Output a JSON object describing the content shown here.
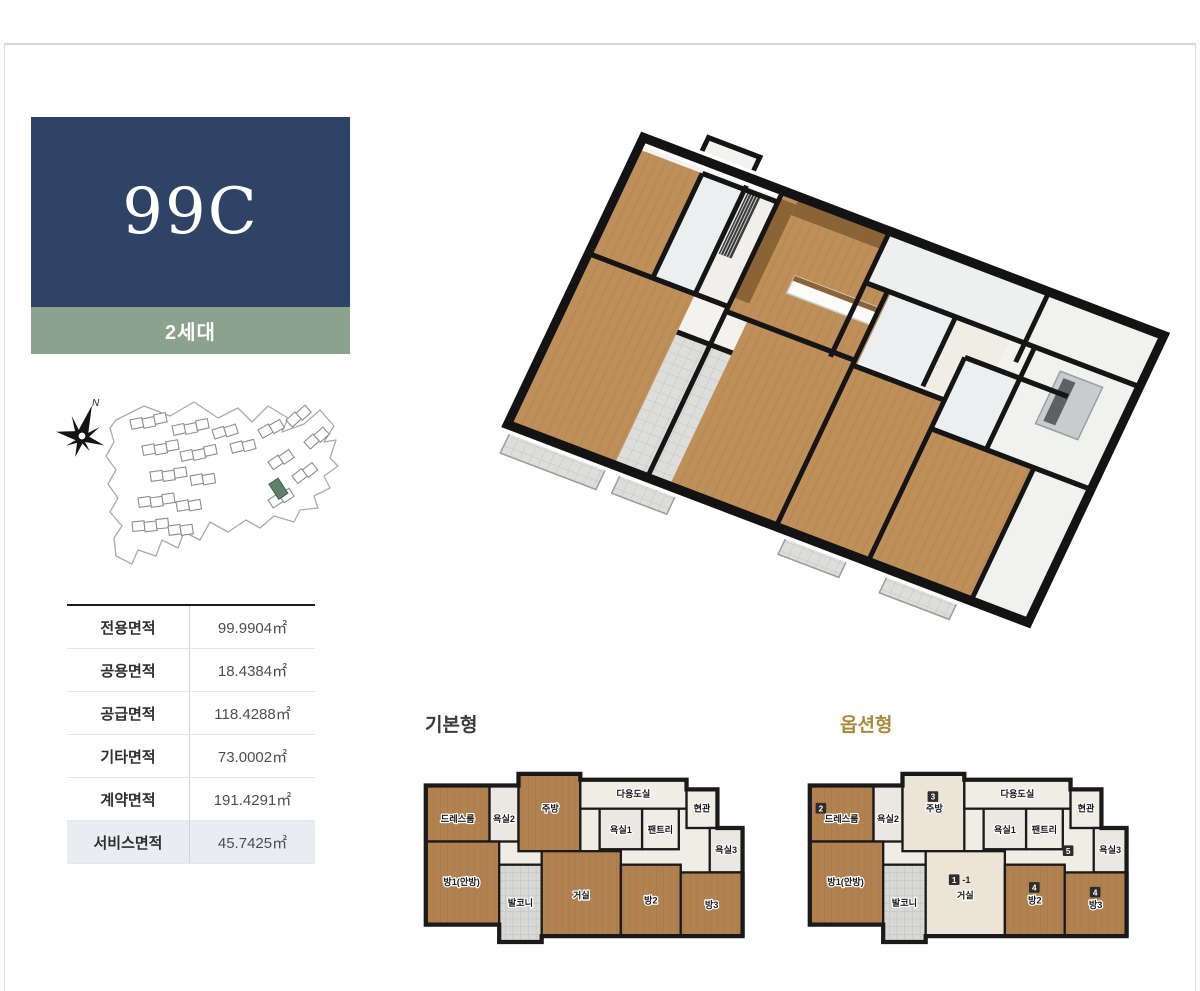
{
  "page": {
    "frame_border_color": "#d6d6d6"
  },
  "sidebar": {
    "unit_code": "99C",
    "households": "2세대",
    "colors": {
      "unit_bg": "#2e4365",
      "households_bg": "#8ba28e",
      "sitemap_highlight": "#5e8169"
    },
    "sitemap": {
      "compass_label": "N"
    },
    "area_table": {
      "rows": [
        {
          "label": "전용면적",
          "value": "99.9904㎡"
        },
        {
          "label": "공용면적",
          "value": "18.4384㎡"
        },
        {
          "label": "공급면적",
          "value": "118.4288㎡"
        },
        {
          "label": "기타면적",
          "value": "73.0002㎡"
        },
        {
          "label": "계약면적",
          "value": "191.4291㎡"
        },
        {
          "label": "서비스면적",
          "value": "45.7425㎡"
        }
      ]
    }
  },
  "plans": {
    "basic": {
      "label": "기본형",
      "label_color": "#3b3b3b"
    },
    "option": {
      "label": "옵션형",
      "label_color": "#ab8a3d",
      "badges": [
        {
          "text": "2",
          "x": 12,
          "y": 48
        },
        {
          "text": "3",
          "x": 128,
          "y": 36
        },
        {
          "text": "1-1",
          "x": 150,
          "y": 122
        },
        {
          "text": "4",
          "x": 233,
          "y": 130
        },
        {
          "text": "4",
          "x": 296,
          "y": 135
        },
        {
          "text": "5",
          "x": 268,
          "y": 92
        }
      ]
    },
    "floors": {
      "wood": "#b28150",
      "woodline": "#a3744a",
      "tile": "#eae8e1",
      "light": "#f0ede5",
      "balcony": "#d8d8d6",
      "cream": "#ece4d6",
      "wall": "#1a1a1a"
    },
    "outline": "M6,30 H102 V18 H166 V24 H276 V34 H308 V74 H334 V186 H126 V192 H82 V174 H6 Z",
    "rooms": [
      {
        "label": "드레스룸",
        "x": 6,
        "y": 30,
        "w": 66,
        "h": 58,
        "floor": "wood",
        "lx": 39,
        "ly": 68
      },
      {
        "label": "욕실2",
        "x": 72,
        "y": 30,
        "w": 30,
        "h": 58,
        "floor": "tile",
        "lx": 87,
        "ly": 68
      },
      {
        "label": "주방",
        "x": 102,
        "y": 18,
        "w": 64,
        "h": 80,
        "floor": "wood",
        "lx": 135,
        "ly": 57,
        "optfloor": "cream"
      },
      {
        "label": "다용도실",
        "x": 166,
        "y": 24,
        "w": 110,
        "h": 30,
        "floor": "light",
        "lx": 221,
        "ly": 42
      },
      {
        "label": "현관",
        "x": 276,
        "y": 34,
        "w": 32,
        "h": 40,
        "floor": "light",
        "lx": 292,
        "ly": 57
      },
      {
        "label": "욕실1",
        "x": 186,
        "y": 54,
        "w": 44,
        "h": 42,
        "floor": "tile",
        "lx": 208,
        "ly": 79
      },
      {
        "label": "팬트리",
        "x": 230,
        "y": 54,
        "w": 38,
        "h": 42,
        "floor": "light",
        "lx": 249,
        "ly": 79
      },
      {
        "label": "욕실3",
        "x": 300,
        "y": 74,
        "w": 34,
        "h": 46,
        "floor": "tile",
        "lx": 317,
        "ly": 100
      },
      {
        "label": "방1(안방)",
        "x": 6,
        "y": 88,
        "w": 76,
        "h": 86,
        "floor": "wood",
        "lx": 43,
        "ly": 133
      },
      {
        "label": "발코니",
        "x": 82,
        "y": 112,
        "w": 44,
        "h": 80,
        "floor": "balcony",
        "lx": 104,
        "ly": 155
      },
      {
        "label": "거실",
        "x": 126,
        "y": 98,
        "w": 82,
        "h": 88,
        "floor": "wood",
        "lx": 167,
        "ly": 147,
        "optfloor": "cream"
      },
      {
        "label": "방2",
        "x": 208,
        "y": 112,
        "w": 62,
        "h": 74,
        "floor": "wood",
        "lx": 239,
        "ly": 152
      },
      {
        "label": "방3",
        "x": 270,
        "y": 120,
        "w": 65,
        "h": 66,
        "floor": "wood",
        "lx": 302,
        "ly": 157
      }
    ]
  }
}
